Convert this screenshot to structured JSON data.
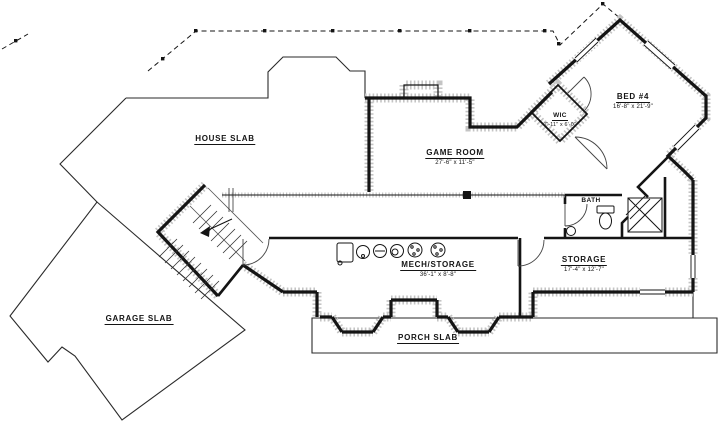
{
  "colors": {
    "line": "#141414",
    "stipple": "#c4c4c4",
    "background": "#ffffff"
  },
  "rooms": {
    "house_slab": {
      "label": "HOUSE SLAB"
    },
    "garage_slab": {
      "label": "GARAGE SLAB"
    },
    "game_room": {
      "label": "GAME ROOM",
      "dims": "27'-6\" x 11'-5\""
    },
    "bed4": {
      "label": "BED #4",
      "dims": "16'-8\" x 21'-9\""
    },
    "wic": {
      "label": "WIC",
      "dims": "7'-11\" x 6'-0\""
    },
    "bath": {
      "label": "BATH"
    },
    "storage": {
      "label": "STORAGE",
      "dims": "17'-4\" x 12'-7\""
    },
    "mech_storage": {
      "label": "MECH/STORAGE",
      "dims": "36'-1\" x 8'-8\""
    },
    "porch_slab": {
      "label": "PORCH SLAB"
    }
  }
}
